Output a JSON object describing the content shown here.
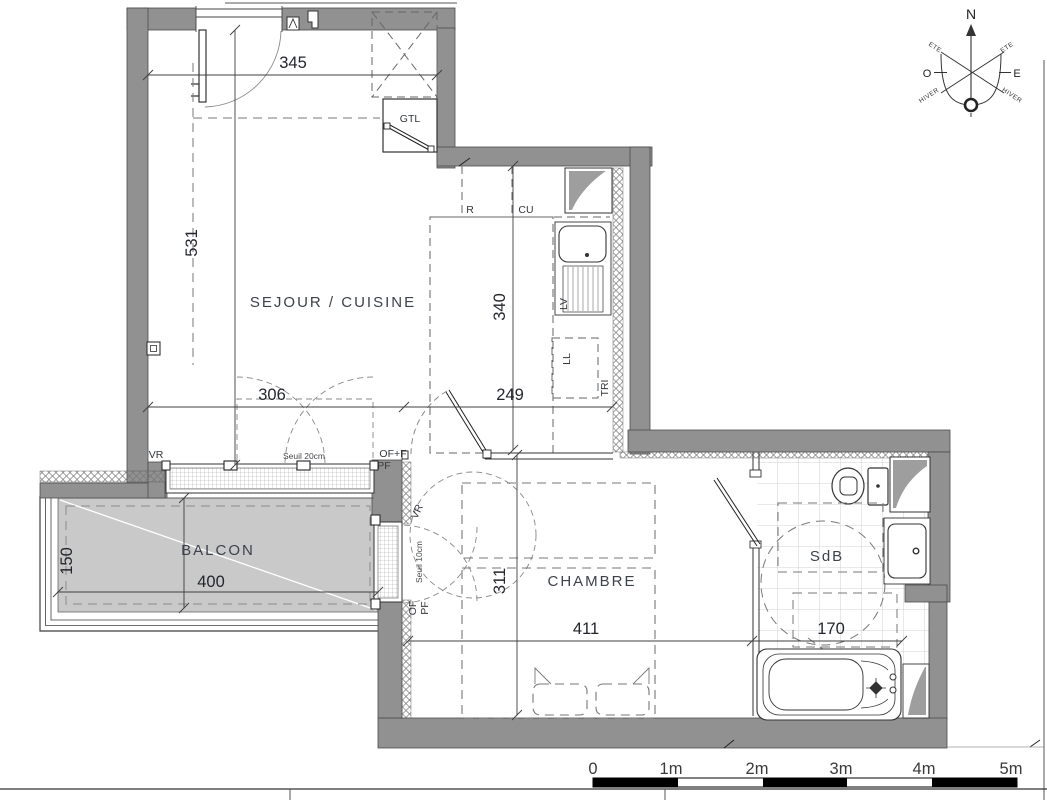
{
  "rooms": {
    "sejour": "SEJOUR / CUISINE",
    "chambre": "CHAMBRE",
    "sdb": "SdB",
    "balcon": "BALCON"
  },
  "dims": {
    "sejour_w": "345",
    "sejour_h": "531",
    "kitchen_d": "340",
    "south_a": "306",
    "south_b": "249",
    "chambre_h": "311",
    "chambre_w": "411",
    "sdb_w": "170",
    "balcon_w": "400",
    "balcon_d": "150"
  },
  "labels": {
    "gtl": "GTL",
    "fridge": "R",
    "cooktop": "CU",
    "dishwasher": "LV",
    "washer": "LL",
    "sorting": "TRI",
    "shutter_sejour": "VR",
    "threshold_sejour": "Seuil 20cm",
    "window_type_sejour": "OF+F",
    "window_type2_sejour": "PF",
    "shutter_chambre": "VR",
    "threshold_chambre": "Seuil 10cm",
    "window_type_chambre": "OF",
    "window_type2_chambre": "PF"
  },
  "compass": {
    "north": "N",
    "west": "O",
    "east": "E",
    "summer_nw": "ETE",
    "summer_ne": "ETE",
    "winter_sw": "HIVER",
    "winter_se": "HIVER"
  },
  "scale_bar": {
    "ticks": [
      "0",
      "1m",
      "2m",
      "3m",
      "4m",
      "5m"
    ]
  },
  "colors": {
    "wall": "#919191",
    "balcony_floor": "#c9c9c9",
    "shaft": "#9e9e9e",
    "line": "#3f3f3f"
  }
}
